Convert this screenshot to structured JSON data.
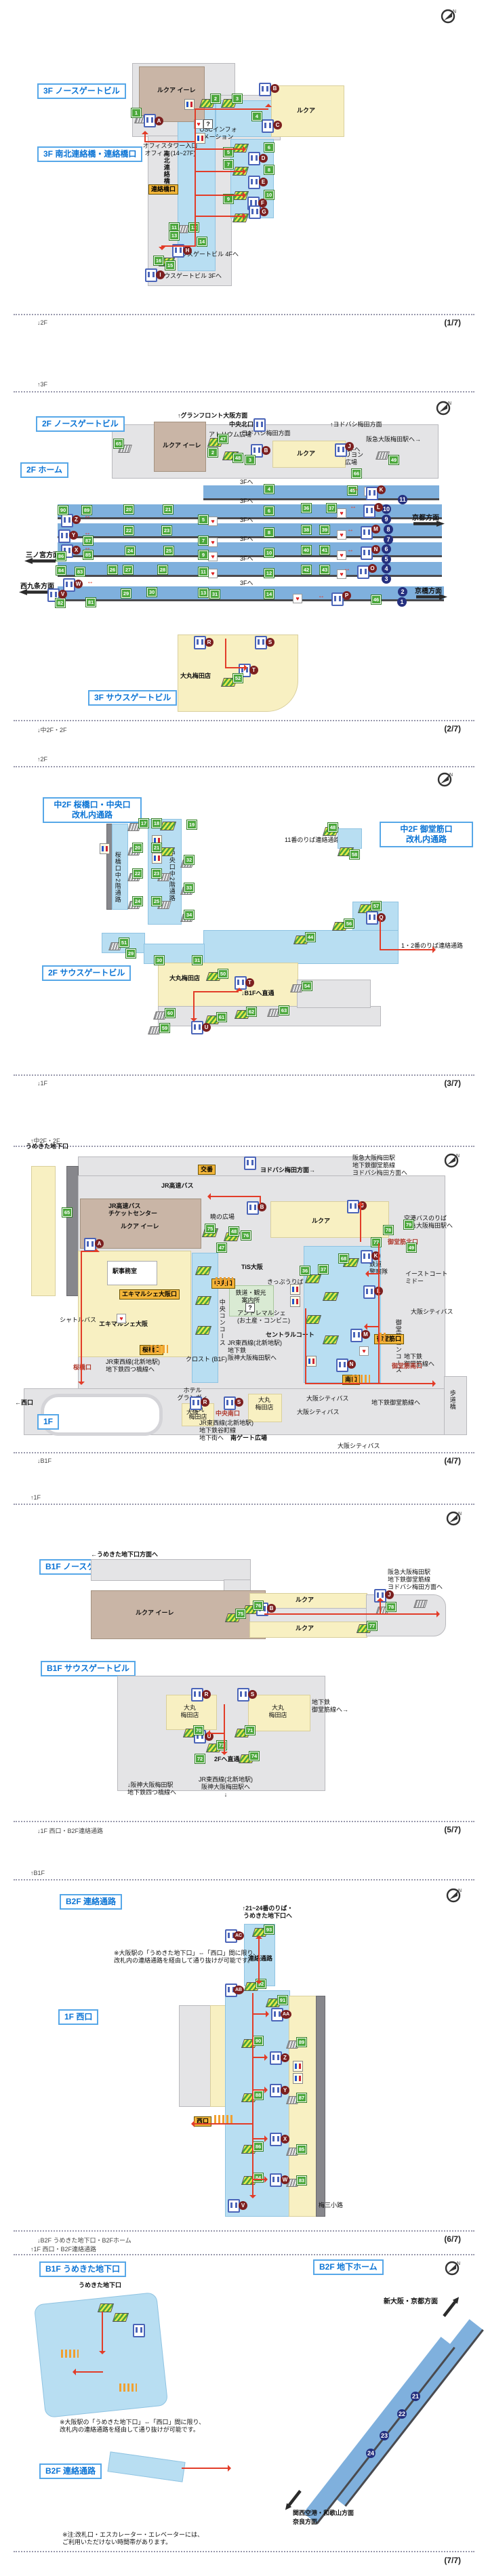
{
  "meta": {
    "compass_n": "N"
  },
  "p1": {
    "foot": "↓2F",
    "num": "(1/7)",
    "title": "3F ノースゲートビル",
    "title2": "3F 南北連絡橋・連絡橋口",
    "lucua_eire": "ルクア イーレ",
    "lucua": "ルクア",
    "office": "オフィスタワー入口\nオフィス (14~27F)",
    "osc": "OSCインフォ\nメーション",
    "bridge": "南北連絡橋",
    "gate": "連絡橋口",
    "sgb4": "サウスゲートビル 4Fへ",
    "sgb3": "サウスゲートビル 3Fへ",
    "st": {
      "n1": "1",
      "n2": "2",
      "n3": "3",
      "n4": "4",
      "n5": "5",
      "n6": "6",
      "n7": "7",
      "n8": "8",
      "n9": "9",
      "n10": "10",
      "n11": "11",
      "n12": "12",
      "n13": "13",
      "n14": "14",
      "n15": "15",
      "n16": "16"
    },
    "lt": {
      "A": "A",
      "B": "B",
      "C": "C",
      "D": "D",
      "E": "E",
      "F": "F",
      "G": "G",
      "H": "H",
      "I": "I"
    }
  },
  "p2": {
    "head": "↑3F",
    "foot": "↓中2F・2F",
    "num": "(2/7)",
    "title": "2F ノースゲートビル",
    "title_home": "2F ホーム",
    "granfront": "↑グランフロント大阪方面",
    "chuo_kita": "中央北口",
    "atrium": "アトリウム広場",
    "yodobashi": "↑ヨドバシ梅田方面",
    "hankyu": "阪急大阪梅田駅へ→",
    "lucua_eire": "ルクア イーレ",
    "lucua": "ルクア",
    "carillon": "カリヨン\n広場",
    "to1f": "1Fへ",
    "to3f": "3Fへ",
    "dir_sannomiya": "三ノ宮方面",
    "dir_nishikujo": "西九条方面",
    "dir_kyoto": "京都方面",
    "dir_kyobashi": "京橋方面",
    "title_sgb": "3F サウスゲートビル",
    "daimaru": "大丸梅田店",
    "pf": [
      "11",
      "10",
      "9",
      "8",
      "7",
      "6",
      "5",
      "4",
      "3",
      "2",
      "1"
    ],
    "st": {
      "n2": "2",
      "n3": "3",
      "n4": "4",
      "n5": "5",
      "n6": "6",
      "n7": "7",
      "n8": "8",
      "n9": "9",
      "n10": "10",
      "n11": "11",
      "n12": "12",
      "n13": "13",
      "n14": "14",
      "n20": "20",
      "n21": "21",
      "n22": "22",
      "n23": "23",
      "n24": "24",
      "n25": "25",
      "n26": "26",
      "n27": "27",
      "n28": "28",
      "n29": "29",
      "n30": "30",
      "n31": "31",
      "n36": "36",
      "n37": "37",
      "n38": "38",
      "n39": "39",
      "n40": "40",
      "n41": "41",
      "n42": "42",
      "n43": "43",
      "n45": "45",
      "n46": "46",
      "n47": "47",
      "n48": "48",
      "n49": "49",
      "n52": "52",
      "n65": "65",
      "n66": "66",
      "n81": "81",
      "n82": "82",
      "n83": "83",
      "n84": "84",
      "n85": "85",
      "n86": "86",
      "n87": "87",
      "n89": "89",
      "n90": "90"
    },
    "lt": {
      "B": "B",
      "J": "J",
      "K": "K",
      "L": "L",
      "M": "M",
      "N": "N",
      "O": "O",
      "P": "P",
      "R": "R",
      "S": "S",
      "T": "T",
      "V": "V",
      "W": "W",
      "X": "X",
      "Y": "Y",
      "Z": "Z"
    }
  },
  "p3": {
    "head": "↑2F",
    "foot": "↓1F",
    "num": "(3/7)",
    "title": "中2F 桜橋口・中央口\n改札内通路",
    "title2": "中2F 御堂筋口\n改札内通路",
    "title3": "2F サウスゲートビル",
    "cor_sakura": "桜橋口中2階通路",
    "cor_chuo": "中央口中2階通路",
    "p11": "11番のりば連絡通路",
    "p12": "1・2番のりば連絡通路",
    "daimaru": "大丸梅田店",
    "b1f": "↓B1Fへ直通",
    "st": {
      "n17": "17",
      "n18": "18",
      "n19": "19",
      "n20": "20",
      "n21": "21",
      "n22": "22",
      "n23": "23",
      "n24": "24",
      "n25": "25",
      "n29": "29",
      "n30": "30",
      "n31": "31",
      "n32": "32",
      "n33": "33",
      "n34": "34",
      "n44": "44",
      "n48": "48",
      "n50": "50",
      "n51": "51",
      "n54": "54",
      "n56": "56",
      "n57": "57",
      "n58": "58",
      "n59": "59",
      "n60": "60",
      "n61": "61",
      "n62": "62",
      "n63": "63"
    },
    "lt": {
      "Q": "Q",
      "T": "T",
      "U": "U"
    }
  },
  "p4": {
    "head": "↑中2F・2F",
    "foot": "↓B1F",
    "num": "(4/7)",
    "title": "1F",
    "umekita": "うめきた地下口",
    "koban": "交番",
    "yodobashi": "ヨドバシ梅田方面→",
    "hankyu3": "阪急大阪梅田駅\n地下鉄御堂筋線\nヨドバシ梅田方面へ",
    "jrbus": "JR高速バス",
    "jrbus_tc": "JR高速バス\nチケットセンター",
    "lucua_eire": "ルクア イーレ",
    "akatsuki": "暁の広場",
    "lucua": "ルクア",
    "airport": "空港バスのりば\n阪急大阪梅田駅へ",
    "midosuji_kita": "御堂筋北口",
    "office": "駅事務室",
    "tis": "TiS大阪",
    "police": "鉄道\n警察隊",
    "info": "鉄道・観光\n案内所\n?",
    "ekimaru": "エキマルシェ大阪",
    "ekimaru_gate": "エキマルシェ大阪口",
    "eastcourt": "イーストコート\nミドー",
    "citybus": "大阪シティバス",
    "midosuji_con": "御堂筋コンコース",
    "midosuji_gate": "御堂筋口",
    "shuttle": "シャトルバス",
    "chuo_gate": "中央口",
    "ticket": "きっぷうりば",
    "chuo_con": "中央コンコース",
    "entre": "アントレマルシェ\n(お土産・コンビニ)",
    "central": "セントラルコート",
    "tozai_hanshin": "JR東西線(北新地駅)\n地下鉄\n阪神大阪梅田駅へ",
    "crost": "クロスト (B1F)",
    "sakurabashi_gate": "桜橋口",
    "sakurabashi_red": "桜橋口",
    "tozai_yotsubashi": "JR東西線(北新地駅)\n地下鉄四つ橋線へ",
    "nishiguchi": "←西口",
    "hotel": "ホテル\nグランヴィア\n大阪",
    "daimaru": "大丸\n梅田店",
    "chuo_minami": "中央南口",
    "minami_gate": "南口",
    "midosuji_sub": "地下鉄御堂筋線へ",
    "midosuji_sub2": "地下鉄\n御堂筋線へ",
    "midosuji_minami": "御堂筋南口",
    "hodokyo": "歩道橋",
    "minami_plaza": "南ゲート広場",
    "tozai_tanimachi": "JR東西線(北新地駅)\n地下鉄谷町線\n地下街へ",
    "st": {
      "n36": "36",
      "n37": "37",
      "n47": "47",
      "n48": "48",
      "n49": "49",
      "n65": "65",
      "n68": "68",
      "n75": "75",
      "n76": "76",
      "n77": "77",
      "n78": "78",
      "n79": "79"
    },
    "lt": {
      "A": "A",
      "B": "B",
      "J": "J",
      "K": "K",
      "L": "L",
      "M": "M",
      "N": "N",
      "R": "R",
      "S": "S"
    }
  },
  "p5": {
    "head": "↑1F",
    "foot": "↓1F 西口・B2F連絡通路",
    "num": "(5/7)",
    "title": "B1F ノースゲートビル",
    "title2": "B1F サウスゲートビル",
    "umekita": "←うめきた地下口方面へ",
    "lucua_eire": "ルクア イーレ",
    "lucua": "ルクア",
    "hankyu3": "阪急大阪梅田駅\n地下鉄御堂筋線\nヨドバシ梅田方面へ",
    "daimaru": "大丸\n梅田店",
    "midosuji": "地下鉄\n御堂筋線へ→",
    "to2f": "2Fへ直通",
    "hanshin": "↓阪神大阪梅田駅\n地下鉄四つ橋線へ",
    "tozai": "JR東西線(北新地駅)\n阪神大阪梅田駅へ\n↓",
    "st": {
      "n70": "70",
      "n71": "71",
      "n72": "72",
      "n73": "73",
      "n74": "74",
      "n75": "75",
      "n76": "76",
      "n77": "77",
      "n78": "78"
    },
    "lt": {
      "B": "B",
      "J": "J",
      "R": "R",
      "S": "S",
      "U": "U"
    }
  },
  "p6": {
    "head": "↑B1F",
    "foot": "↓B2F うめきた地下口・B2Fホーム",
    "num": "(6/7)",
    "title": "B2F 連絡通路",
    "title2": "1F 西口",
    "to2124": "↑21~24番のりば・\nうめきた地下口へ",
    "corridor": "連絡通路",
    "note": "※大阪駅の「うめきた地下口」⇔「西口」間に限り、\n改札内の連絡通路を経由して通り抜けが可能です。",
    "gate": "西口",
    "umesan": "梅三小路",
    "st": {
      "n83": "83",
      "n84": "84",
      "n85": "85",
      "n86": "86",
      "n87": "87",
      "n88": "88",
      "n89": "89",
      "n90": "90",
      "n91": "91",
      "n92": "92",
      "n93": "93"
    },
    "lt": {
      "V": "V",
      "W": "W",
      "X": "X",
      "Y": "Y",
      "Z": "Z",
      "AA": "AA",
      "AB": "AB",
      "AC": "AC"
    }
  },
  "p7": {
    "head": "↑1F 西口・B2F連絡通路",
    "num": "(7/7)",
    "title": "B1F うめきた地下口",
    "title2": "B2F 地下ホーム",
    "title3": "B2F 連絡通路",
    "umekita": "うめきた地下口",
    "note": "※大阪駅の「うめきた地下口」⇔「西口」間に限り、\n改札内の連絡通路を経由して通り抜けが可能です。",
    "shinosaka": "新大阪・京都方面",
    "kansai": "関西空港・和歌山方面\n奈良方面",
    "footnote": "※注:改札口・エスカレーター・エレベーターには、\nご利用いただけない時間帯があります。",
    "pf": [
      "21",
      "22",
      "23",
      "24"
    ]
  }
}
